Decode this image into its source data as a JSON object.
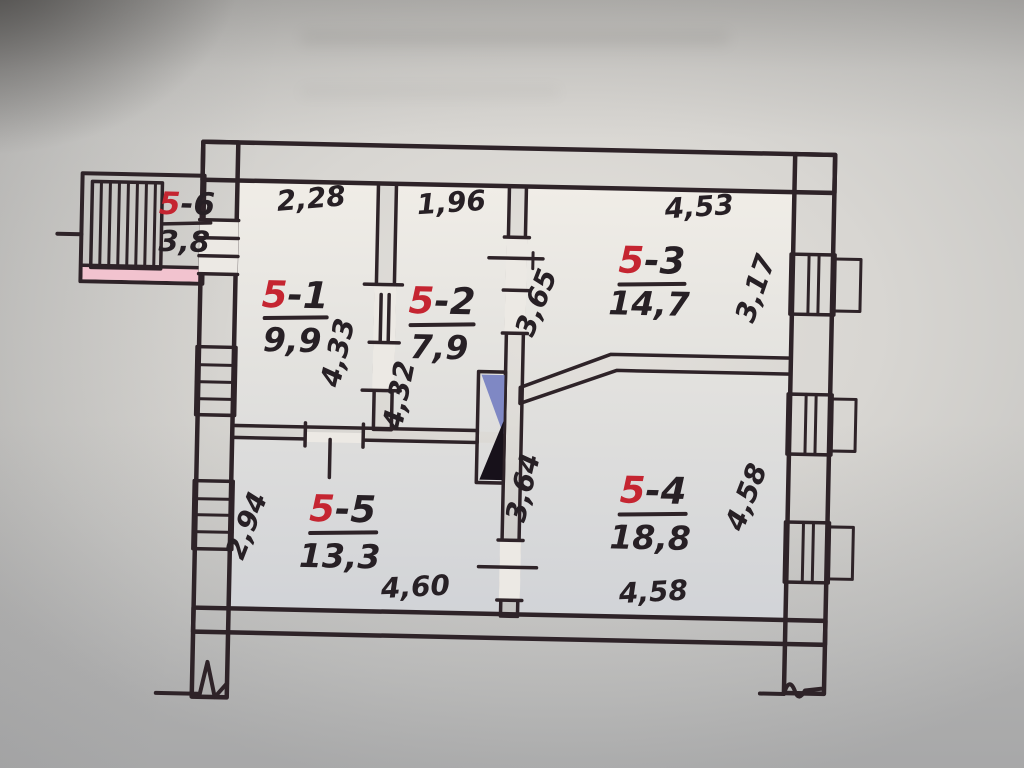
{
  "drawing": {
    "kind": "hand-drawn apartment floor plan photo",
    "colors": {
      "wall_pink": "#f0b7c5",
      "wall_pink_light": "#f4c9d4",
      "ink": "#2e2328",
      "red_label": "#c52531",
      "paper": "#e6e3de",
      "shaft_blue": "#7f88c4",
      "shaft_black": "#17111a"
    }
  },
  "rooms": {
    "r1": {
      "prefix": "5",
      "suffix": "-1",
      "area": "9,9"
    },
    "r2": {
      "prefix": "5",
      "suffix": "-2",
      "area": "7,9"
    },
    "r3": {
      "prefix": "5",
      "suffix": "-3",
      "area": "14,7"
    },
    "r4": {
      "prefix": "5",
      "suffix": "-4",
      "area": "18,8"
    },
    "r5": {
      "prefix": "5",
      "suffix": "-5",
      "area": "13,3"
    },
    "r6": {
      "prefix": "5",
      "suffix": "-6",
      "area": "3,8"
    }
  },
  "dimensions": {
    "top_r1": "2,28",
    "top_r2": "1,96",
    "top_r3": "4,53",
    "r1_height": "4,33",
    "r2_height": "4,32",
    "r3_left": "3,65",
    "r3_right": "3,17",
    "r4_left": "3,64",
    "r4_right": "4,58",
    "r4_bottom": "4,58",
    "r5_bottom": "4,60",
    "r5_left": "2,94"
  }
}
